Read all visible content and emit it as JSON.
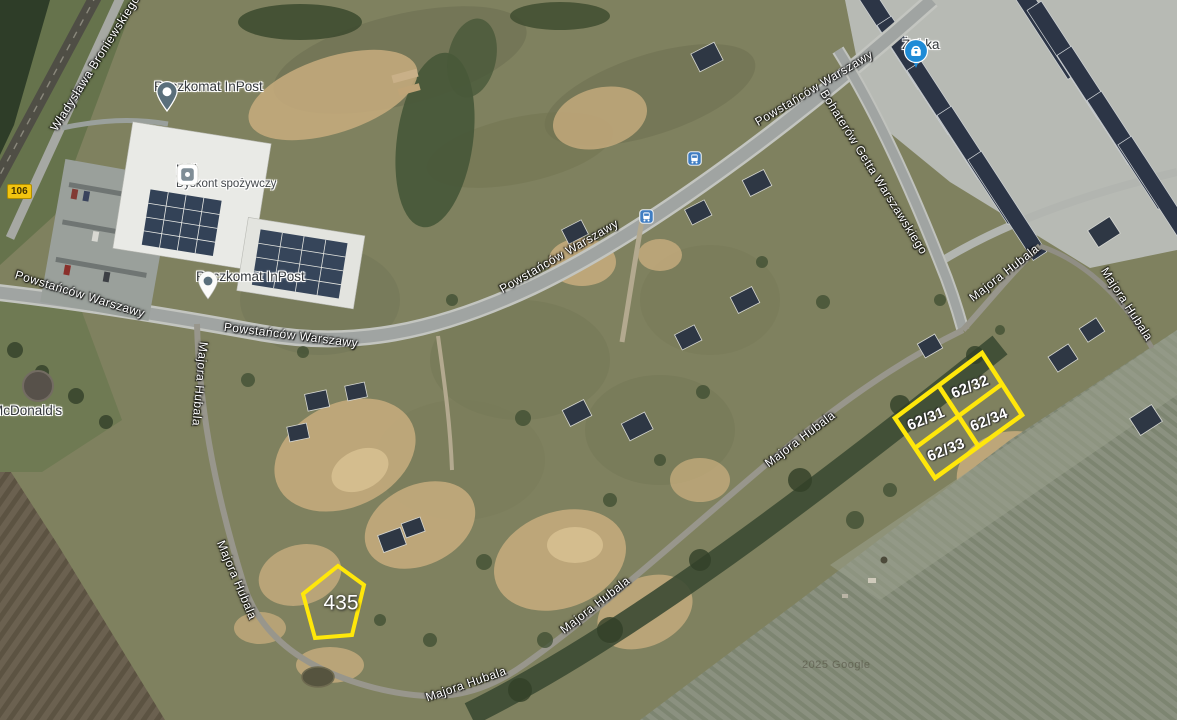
{
  "map": {
    "watermark": "2025 Google",
    "road_badge_106": "106"
  },
  "streets": {
    "wladyslawa_broniewskiego": "Władysława Broniewskiego",
    "powstancow_warszawy": "Powstańców Warszawy",
    "bohaterow_getta": "Bohaterów Getta Warszawskiego",
    "majora_hubala": "Majora Hubala"
  },
  "pois": {
    "paczkomat_inpost": "Paczkomat InPost",
    "lidl": {
      "name": "Lidl",
      "subtitle": "Dyskont spożywczy"
    },
    "zabka": "Żabka",
    "mcdonalds": "McDonald's"
  },
  "parcels": {
    "p62_31": "62/31",
    "p62_32": "62/32",
    "p62_33": "62/33",
    "p62_34": "62/34",
    "p435": "435"
  },
  "colors": {
    "parcel_outline": "#ffe70a",
    "transit_blue": "#3f7dc2",
    "zabka_blue": "#1f8bd6",
    "inpost_pin_slate": "#5a6f7b",
    "road_badge_yellow": "#f2c40f"
  }
}
